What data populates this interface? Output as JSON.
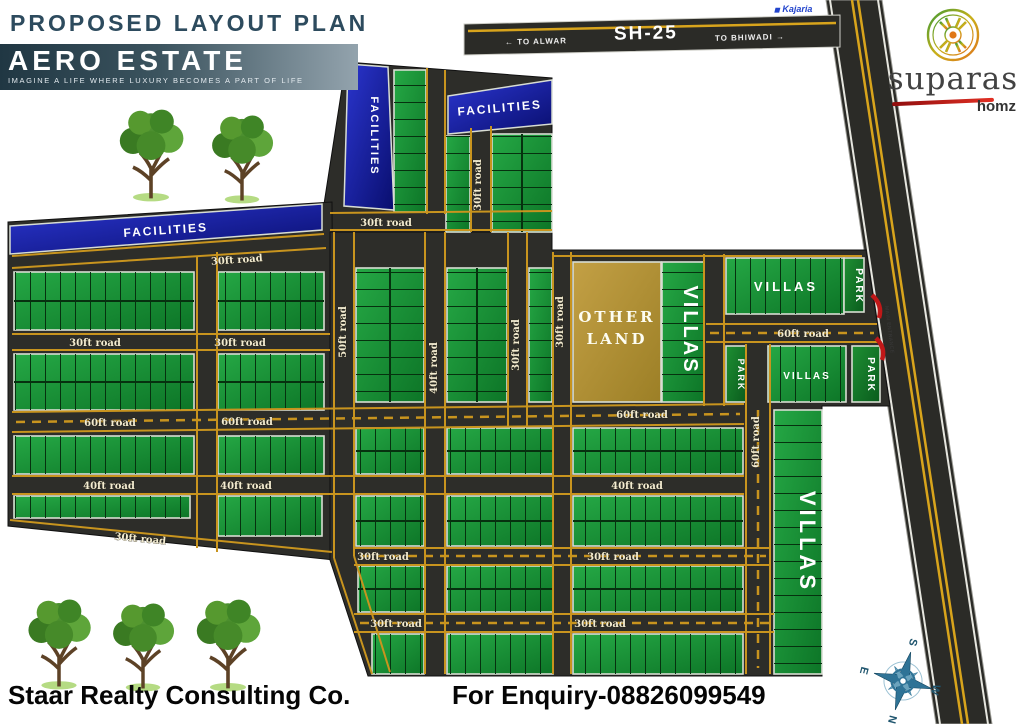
{
  "header": {
    "plan_title": "PROPOSED LAYOUT PLAN",
    "estate_name": "AERO ESTATE",
    "tagline": "IMAGINE A LIFE WHERE LUXURY BECOMES A PART OF LIFE"
  },
  "brand": {
    "name": "suparas",
    "sub": "homz",
    "partner": "Kajaria"
  },
  "highway": {
    "name": "SH-25",
    "to_left": "← TO ALWAR",
    "to_right": "TO BHIWADI →",
    "entrance": "MAIN ENTRANCE"
  },
  "map": {
    "labels": {
      "r30": "30ft road",
      "r40": "40ft road",
      "r50": "50ft road",
      "r60": "60ft road"
    },
    "zones": {
      "facilities": "FACILITIES",
      "villas": "VILLAS",
      "park": "PARK",
      "other_land_1": "OTHER",
      "other_land_2": "LAND"
    }
  },
  "compass": {
    "n": "N",
    "s": "S",
    "e": "E",
    "w": "W"
  },
  "footer": {
    "company": "Staar Realty Consulting Co.",
    "enquiry": "For Enquiry-08826099549"
  }
}
